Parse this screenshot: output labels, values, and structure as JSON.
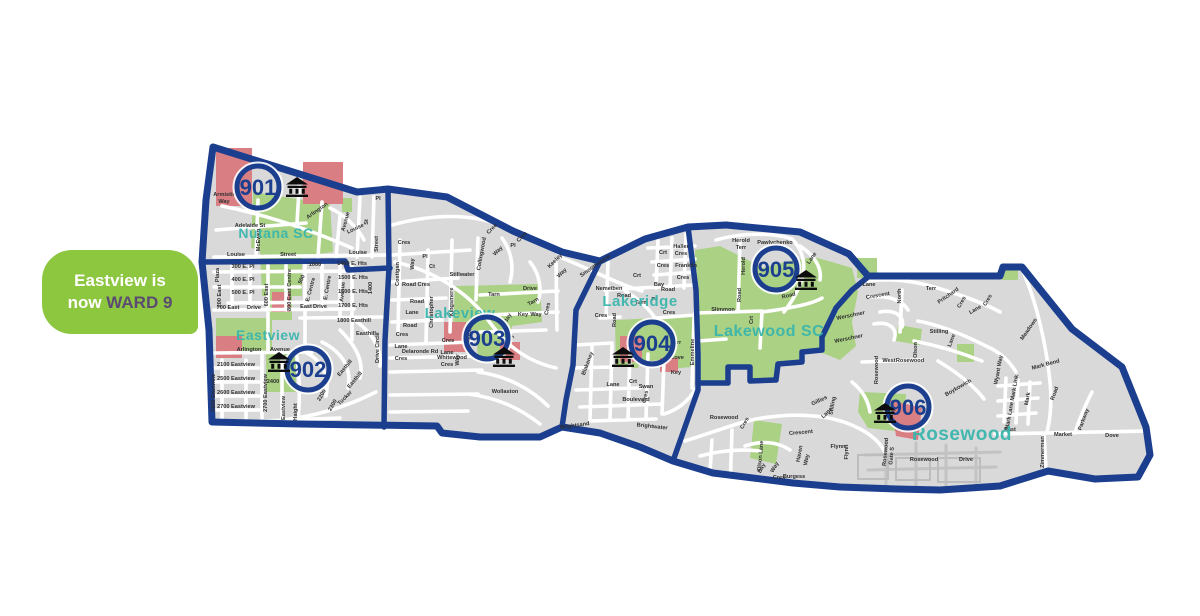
{
  "callout": {
    "line1": "Eastview is",
    "line2_prefix": "now ",
    "line2_highlight": "WARD 9"
  },
  "colors": {
    "boundary_navy": "#1b3e8e",
    "map_gray": "#d9d9d9",
    "street_white": "#ffffff",
    "park_green": "#aad184",
    "school_red": "#d97f84",
    "label_teal": "#3ab6ad",
    "rosewood_teal": "#8ad2cb",
    "callout_green": "#8dc63f",
    "callout_text_white": "#ffffff",
    "ward9_purple": "#5b4b73",
    "street_label_dark": "#2e2e2e",
    "building_icon_black": "#0d0d0d"
  },
  "map": {
    "wards": [
      {
        "number": "901",
        "cx": 258,
        "cy": 187,
        "icon_x": 297,
        "icon_y": 186
      },
      {
        "number": "902",
        "cx": 308,
        "cy": 369,
        "icon_x": 279,
        "icon_y": 361
      },
      {
        "number": "903",
        "cx": 487,
        "cy": 338,
        "icon_x": 504,
        "icon_y": 356
      },
      {
        "number": "904",
        "cx": 652,
        "cy": 343,
        "icon_x": 623,
        "icon_y": 356
      },
      {
        "number": "905",
        "cx": 776,
        "cy": 269,
        "icon_x": 806,
        "icon_y": 279
      },
      {
        "number": "906",
        "cx": 908,
        "cy": 407,
        "icon_x": 885,
        "icon_y": 412
      }
    ],
    "neighborhoods": [
      {
        "name": "Nutana SC",
        "x": 276,
        "y": 238,
        "size": 14,
        "light": false
      },
      {
        "name": "Eastview",
        "x": 268,
        "y": 340,
        "size": 14,
        "light": false
      },
      {
        "name": "Lakeview",
        "x": 460,
        "y": 318,
        "size": 15,
        "light": false
      },
      {
        "name": "Lakeridge",
        "x": 640,
        "y": 306,
        "size": 15,
        "light": false
      },
      {
        "name": "Lakewood SC",
        "x": 769,
        "y": 336,
        "size": 16,
        "light": false
      },
      {
        "name": "Rosewood",
        "x": 962,
        "y": 440,
        "size": 19,
        "light": true
      }
    ],
    "street_labels": [
      {
        "t": "Armistice",
        "x": 226,
        "y": 196,
        "r": 0
      },
      {
        "t": "Way",
        "x": 224,
        "y": 203,
        "r": 0
      },
      {
        "t": "Adelaide St",
        "x": 250,
        "y": 227,
        "r": 0
      },
      {
        "t": "McEwen",
        "x": 260,
        "y": 240,
        "r": -90
      },
      {
        "t": "Louise",
        "x": 236,
        "y": 256,
        "r": 0
      },
      {
        "t": "Street",
        "x": 288,
        "y": 256,
        "r": 0
      },
      {
        "t": "Arlington",
        "x": 318,
        "y": 212,
        "r": -35
      },
      {
        "t": "Avenue",
        "x": 347,
        "y": 222,
        "r": -75
      },
      {
        "t": "Louise",
        "x": 356,
        "y": 230,
        "r": -25
      },
      {
        "t": "Pl",
        "x": 378,
        "y": 200,
        "r": 0
      },
      {
        "t": "St",
        "x": 368,
        "y": 222,
        "r": -90
      },
      {
        "t": "Street",
        "x": 378,
        "y": 244,
        "r": -90
      },
      {
        "t": "Louise",
        "x": 358,
        "y": 254,
        "r": 0
      },
      {
        "t": "Plaza",
        "x": 219,
        "y": 275,
        "r": -90
      },
      {
        "t": "300 E. Pl",
        "x": 243,
        "y": 268,
        "r": 0
      },
      {
        "t": "400 E. Pl",
        "x": 243,
        "y": 281,
        "r": 0
      },
      {
        "t": "500 E. Pl",
        "x": 243,
        "y": 294,
        "r": 0
      },
      {
        "t": "200 East",
        "x": 221,
        "y": 296,
        "r": -90
      },
      {
        "t": "700 East",
        "x": 228,
        "y": 309,
        "r": 0
      },
      {
        "t": "Drive",
        "x": 254,
        "y": 309,
        "r": 0
      },
      {
        "t": "600 East",
        "x": 268,
        "y": 295,
        "r": -90
      },
      {
        "t": "800 East Centre",
        "x": 291,
        "y": 290,
        "r": -90
      },
      {
        "t": "900",
        "x": 303,
        "y": 280,
        "r": -65
      },
      {
        "t": "E. Centre",
        "x": 312,
        "y": 290,
        "r": -75
      },
      {
        "t": "1000",
        "x": 315,
        "y": 266,
        "r": 0
      },
      {
        "t": "E. Centre",
        "x": 329,
        "y": 288,
        "r": -80
      },
      {
        "t": "Avenue",
        "x": 344,
        "y": 292,
        "r": -85
      },
      {
        "t": "East",
        "x": 306,
        "y": 308,
        "r": 0
      },
      {
        "t": "Drive",
        "x": 320,
        "y": 308,
        "r": 0
      },
      {
        "t": "1400 E. Hts",
        "x": 352,
        "y": 265,
        "r": 0
      },
      {
        "t": "1500 E. Hts",
        "x": 353,
        "y": 279,
        "r": 0
      },
      {
        "t": "1600 E. Hts",
        "x": 353,
        "y": 293,
        "r": 0
      },
      {
        "t": "1700 E. Hts",
        "x": 353,
        "y": 307,
        "r": 0
      },
      {
        "t": "1400",
        "x": 372,
        "y": 288,
        "r": -90
      },
      {
        "t": "1800 Easthill",
        "x": 354,
        "y": 322,
        "r": 0
      },
      {
        "t": "Easthill",
        "x": 366,
        "y": 335,
        "r": 0
      },
      {
        "t": "Easthill",
        "x": 346,
        "y": 369,
        "r": -50
      },
      {
        "t": "Easthill",
        "x": 356,
        "y": 381,
        "r": -50
      },
      {
        "t": "Arlington",
        "x": 249,
        "y": 351,
        "r": 0
      },
      {
        "t": "Avenue",
        "x": 280,
        "y": 351,
        "r": 0
      },
      {
        "t": "2100 Eastview",
        "x": 236,
        "y": 366,
        "r": 0
      },
      {
        "t": "2500 Eastview",
        "x": 236,
        "y": 380,
        "r": 0
      },
      {
        "t": "2600 Eastview",
        "x": 236,
        "y": 394,
        "r": 0
      },
      {
        "t": "2700 Eastview",
        "x": 236,
        "y": 408,
        "r": 0
      },
      {
        "t": "2100 Eastview",
        "x": 215,
        "y": 393,
        "r": -90
      },
      {
        "t": "2700 Eastview",
        "x": 267,
        "y": 393,
        "r": -90
      },
      {
        "t": "2400",
        "x": 273,
        "y": 383,
        "r": 0
      },
      {
        "t": "Eastview",
        "x": 285,
        "y": 408,
        "r": -90
      },
      {
        "t": "Haight",
        "x": 297,
        "y": 412,
        "r": -90
      },
      {
        "t": "2200",
        "x": 323,
        "y": 396,
        "r": -60
      },
      {
        "t": "2300",
        "x": 334,
        "y": 406,
        "r": -60
      },
      {
        "t": "Tucker",
        "x": 346,
        "y": 399,
        "r": -45
      },
      {
        "t": "Circle",
        "x": 379,
        "y": 340,
        "r": -90
      },
      {
        "t": "Drive",
        "x": 379,
        "y": 356,
        "r": -90
      },
      {
        "t": "Cres",
        "x": 404,
        "y": 244,
        "r": 0
      },
      {
        "t": "Costigan",
        "x": 399,
        "y": 274,
        "r": -90
      },
      {
        "t": "Way",
        "x": 414,
        "y": 264,
        "r": -90
      },
      {
        "t": "Pl",
        "x": 425,
        "y": 258,
        "r": 0
      },
      {
        "t": "Ct",
        "x": 432,
        "y": 268,
        "r": 0
      },
      {
        "t": "Road Cres",
        "x": 416,
        "y": 286,
        "r": 0
      },
      {
        "t": "Road",
        "x": 417,
        "y": 303,
        "r": 0
      },
      {
        "t": "Lane",
        "x": 412,
        "y": 314,
        "r": 0
      },
      {
        "t": "Road",
        "x": 410,
        "y": 327,
        "r": 0
      },
      {
        "t": "Christopher",
        "x": 433,
        "y": 312,
        "r": -90
      },
      {
        "t": "Kingsmere",
        "x": 453,
        "y": 302,
        "r": -90
      },
      {
        "t": "Stillwater",
        "x": 462,
        "y": 276,
        "r": 0
      },
      {
        "t": "Lakeshore",
        "x": 471,
        "y": 332,
        "r": -80
      },
      {
        "t": "Cres",
        "x": 448,
        "y": 342,
        "r": 0
      },
      {
        "t": "Lane",
        "x": 447,
        "y": 354,
        "r": 0
      },
      {
        "t": "Cres",
        "x": 447,
        "y": 366,
        "r": 0
      },
      {
        "t": "Way",
        "x": 459,
        "y": 360,
        "r": -90
      },
      {
        "t": "Collingwood",
        "x": 483,
        "y": 254,
        "r": -80
      },
      {
        "t": "Cree",
        "x": 493,
        "y": 230,
        "r": -45
      },
      {
        "t": "Way",
        "x": 499,
        "y": 252,
        "r": -45
      },
      {
        "t": "Pl",
        "x": 513,
        "y": 247,
        "r": 0
      },
      {
        "t": "Cres",
        "x": 523,
        "y": 238,
        "r": -45
      },
      {
        "t": "Tarn",
        "x": 494,
        "y": 296,
        "r": 0
      },
      {
        "t": "Drive",
        "x": 530,
        "y": 290,
        "r": 0
      },
      {
        "t": "Tarn",
        "x": 534,
        "y": 303,
        "r": -30
      },
      {
        "t": "Key",
        "x": 523,
        "y": 316,
        "r": 0
      },
      {
        "t": "Way",
        "x": 536,
        "y": 316,
        "r": 0
      },
      {
        "t": "Cres",
        "x": 549,
        "y": 309,
        "r": -80
      },
      {
        "t": "Bay",
        "x": 509,
        "y": 319,
        "r": -60
      },
      {
        "t": "Keeley",
        "x": 556,
        "y": 262,
        "r": -45
      },
      {
        "t": "Way",
        "x": 563,
        "y": 274,
        "r": -45
      },
      {
        "t": "Delaronde Rd",
        "x": 420,
        "y": 353,
        "r": 0
      },
      {
        "t": "Whitewood",
        "x": 452,
        "y": 359,
        "r": 0
      },
      {
        "t": "Wollaston",
        "x": 505,
        "y": 393,
        "r": 0
      },
      {
        "t": "Cres",
        "x": 402,
        "y": 336,
        "r": 0
      },
      {
        "t": "Lane",
        "x": 401,
        "y": 348,
        "r": 0
      },
      {
        "t": "Cres",
        "x": 401,
        "y": 360,
        "r": 0
      },
      {
        "t": "Bay",
        "x": 512,
        "y": 340,
        "r": -70
      },
      {
        "t": "Smoothstone",
        "x": 596,
        "y": 267,
        "r": -35
      },
      {
        "t": "Nemeiben",
        "x": 609,
        "y": 290,
        "r": 0
      },
      {
        "t": "Road",
        "x": 624,
        "y": 297,
        "r": 0
      },
      {
        "t": "Haller",
        "x": 681,
        "y": 248,
        "r": 0
      },
      {
        "t": "Cres",
        "x": 681,
        "y": 255,
        "r": 0
      },
      {
        "t": "Franklin",
        "x": 686,
        "y": 267,
        "r": 0
      },
      {
        "t": "Cres",
        "x": 683,
        "y": 279,
        "r": 0
      },
      {
        "t": "Crt",
        "x": 663,
        "y": 254,
        "r": 0
      },
      {
        "t": "Cres",
        "x": 663,
        "y": 267,
        "r": 0
      },
      {
        "t": "Bay",
        "x": 659,
        "y": 286,
        "r": 0
      },
      {
        "t": "Road",
        "x": 668,
        "y": 291,
        "r": 0
      },
      {
        "t": "Crt",
        "x": 637,
        "y": 277,
        "r": 0
      },
      {
        "t": "Tarn",
        "x": 641,
        "y": 304,
        "r": 0
      },
      {
        "t": "Pl",
        "x": 654,
        "y": 301,
        "r": 0
      },
      {
        "t": "Cres",
        "x": 601,
        "y": 317,
        "r": 0
      },
      {
        "t": "Road",
        "x": 616,
        "y": 320,
        "r": -90
      },
      {
        "t": "Cres",
        "x": 669,
        "y": 314,
        "r": 0
      },
      {
        "t": "Emmeline",
        "x": 694,
        "y": 352,
        "r": -90
      },
      {
        "t": "Terr",
        "x": 676,
        "y": 344,
        "r": 0
      },
      {
        "t": "Cove",
        "x": 677,
        "y": 359,
        "r": 0
      },
      {
        "t": "Key",
        "x": 676,
        "y": 374,
        "r": 0
      },
      {
        "t": "Blakeney",
        "x": 589,
        "y": 364,
        "r": -70
      },
      {
        "t": "Lane",
        "x": 613,
        "y": 386,
        "r": 0
      },
      {
        "t": "Crt",
        "x": 633,
        "y": 383,
        "r": 0
      },
      {
        "t": "Swan",
        "x": 646,
        "y": 388,
        "r": 0
      },
      {
        "t": "Cres",
        "x": 647,
        "y": 397,
        "r": -80
      },
      {
        "t": "Boulevard",
        "x": 636,
        "y": 401,
        "r": 0
      },
      {
        "t": "Brightsand",
        "x": 575,
        "y": 427,
        "r": -8
      },
      {
        "t": "Brightwater",
        "x": 652,
        "y": 428,
        "r": 6
      },
      {
        "t": "Herold",
        "x": 741,
        "y": 242,
        "r": 0
      },
      {
        "t": "Terr",
        "x": 741,
        "y": 249,
        "r": 0
      },
      {
        "t": "Pawlychenko",
        "x": 775,
        "y": 244,
        "r": 0
      },
      {
        "t": "Herold",
        "x": 745,
        "y": 266,
        "r": -90
      },
      {
        "t": "Lane",
        "x": 813,
        "y": 259,
        "r": -55
      },
      {
        "t": "Road",
        "x": 741,
        "y": 295,
        "r": -90
      },
      {
        "t": "Road",
        "x": 789,
        "y": 297,
        "r": -15
      },
      {
        "t": "Slimmon",
        "x": 723,
        "y": 311,
        "r": 0
      },
      {
        "t": "Crt",
        "x": 753,
        "y": 320,
        "r": -90
      },
      {
        "t": "Werschner",
        "x": 851,
        "y": 317,
        "r": -12
      },
      {
        "t": "Werschner",
        "x": 849,
        "y": 340,
        "r": -12
      },
      {
        "t": "Lane",
        "x": 869,
        "y": 286,
        "r": 0
      },
      {
        "t": "Crescent",
        "x": 878,
        "y": 297,
        "r": -10
      },
      {
        "t": "North",
        "x": 901,
        "y": 296,
        "r": -90
      },
      {
        "t": "Terr",
        "x": 931,
        "y": 290,
        "r": 0
      },
      {
        "t": "Pritchard",
        "x": 949,
        "y": 297,
        "r": -35
      },
      {
        "t": "Cres",
        "x": 963,
        "y": 303,
        "r": -60
      },
      {
        "t": "Lane",
        "x": 976,
        "y": 311,
        "r": -30
      },
      {
        "t": "Cres",
        "x": 989,
        "y": 301,
        "r": -60
      },
      {
        "t": "Stilling",
        "x": 939,
        "y": 333,
        "r": 0
      },
      {
        "t": "Lane",
        "x": 953,
        "y": 341,
        "r": -70
      },
      {
        "t": "Olson",
        "x": 917,
        "y": 350,
        "r": -90
      },
      {
        "t": "West",
        "x": 889,
        "y": 362,
        "r": 0
      },
      {
        "t": "Rosewood",
        "x": 910,
        "y": 362,
        "r": 0
      },
      {
        "t": "Rosewood",
        "x": 878,
        "y": 370,
        "r": -90
      },
      {
        "t": "Boykowich",
        "x": 959,
        "y": 389,
        "r": -30
      },
      {
        "t": "Mark Bend",
        "x": 1046,
        "y": 366,
        "r": -15
      },
      {
        "t": "Mark Link",
        "x": 1016,
        "y": 388,
        "r": -80
      },
      {
        "t": "Mark",
        "x": 1029,
        "y": 399,
        "r": -80
      },
      {
        "t": "Mark Lane",
        "x": 1011,
        "y": 416,
        "r": -80
      },
      {
        "t": "Wyant Way",
        "x": 1000,
        "y": 370,
        "r": -80
      },
      {
        "t": "Meadows",
        "x": 1030,
        "y": 330,
        "r": -55
      },
      {
        "t": "Road",
        "x": 1056,
        "y": 394,
        "r": -70
      },
      {
        "t": "East",
        "x": 1010,
        "y": 431,
        "r": 0
      },
      {
        "t": "Market",
        "x": 1063,
        "y": 436,
        "r": 0
      },
      {
        "t": "Parkway",
        "x": 1085,
        "y": 420,
        "r": -70
      },
      {
        "t": "Dove",
        "x": 1112,
        "y": 437,
        "r": 0
      },
      {
        "t": "Zimmerman",
        "x": 1044,
        "y": 452,
        "r": -90
      },
      {
        "t": "Stilling",
        "x": 834,
        "y": 406,
        "r": -80
      },
      {
        "t": "Gillies",
        "x": 820,
        "y": 402,
        "r": -25
      },
      {
        "t": "Lane",
        "x": 828,
        "y": 414,
        "r": -45
      },
      {
        "t": "Rosewood",
        "x": 724,
        "y": 419,
        "r": 0
      },
      {
        "t": "Cres",
        "x": 746,
        "y": 424,
        "r": -60
      },
      {
        "t": "Crescent",
        "x": 801,
        "y": 434,
        "r": -5
      },
      {
        "t": "Haven",
        "x": 801,
        "y": 454,
        "r": -80
      },
      {
        "t": "Way",
        "x": 808,
        "y": 460,
        "r": -80
      },
      {
        "t": "Flynn",
        "x": 838,
        "y": 448,
        "r": 0
      },
      {
        "t": "Flynn",
        "x": 848,
        "y": 452,
        "r": -90
      },
      {
        "t": "Burgess",
        "x": 794,
        "y": 478,
        "r": 0
      },
      {
        "t": "Bay",
        "x": 763,
        "y": 469,
        "r": -60
      },
      {
        "t": "Way",
        "x": 776,
        "y": 468,
        "r": -60
      },
      {
        "t": "Cres",
        "x": 779,
        "y": 479,
        "r": 0
      },
      {
        "t": "Rosewood",
        "x": 887,
        "y": 452,
        "r": -85
      },
      {
        "t": "Gate S",
        "x": 893,
        "y": 456,
        "r": -85
      },
      {
        "t": "Rosewood",
        "x": 924,
        "y": 461,
        "r": 0
      },
      {
        "t": "Drive",
        "x": 966,
        "y": 461,
        "r": 0
      },
      {
        "t": "Olson Lane",
        "x": 762,
        "y": 456,
        "r": -85
      }
    ]
  }
}
